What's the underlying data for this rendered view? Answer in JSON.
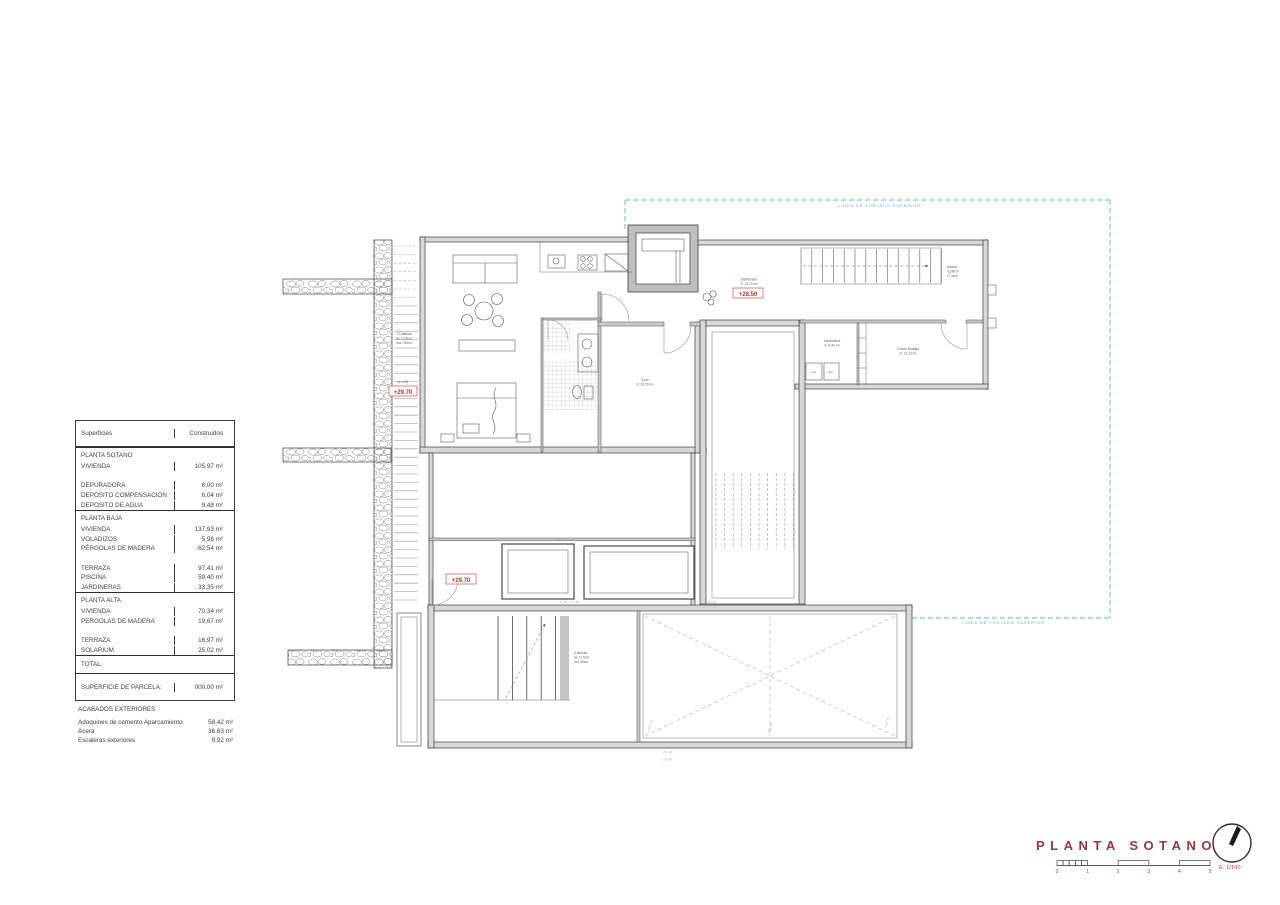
{
  "table": {
    "col1_header": "Superficies",
    "col2_header": "Construidos",
    "sections": [
      {
        "title": "PLANTA SOTANO",
        "rows": [
          [
            "VIVIENDA",
            "105,97 m²"
          ],
          [
            "",
            ""
          ],
          [
            "DEPURADORA",
            "6,00 m²"
          ],
          [
            "DEPOSITO COMPENSACIÓN",
            "6,04 m²"
          ],
          [
            "DEPOSITO DE AGUA",
            "9,48 m²"
          ]
        ]
      },
      {
        "title": "PLANTA BAJA",
        "rows": [
          [
            "VIVIENDA",
            "137,93 m²"
          ],
          [
            "VOLADIZOS",
            "5,98 m²"
          ],
          [
            "PÉRGOLAS DE MADERA",
            "62,54 m²"
          ],
          [
            "",
            ""
          ],
          [
            "TERRAZA",
            "97,41 m²"
          ],
          [
            "PISCINA",
            "59,40 m²"
          ],
          [
            "JARDINERAS",
            "33,35 m²"
          ]
        ]
      },
      {
        "title": "PLANTA ALTA",
        "rows": [
          [
            "VIVIENDA",
            "70,34 m²"
          ],
          [
            "PERGOLAS DE MADERA",
            "19,67 m²"
          ],
          [
            "",
            ""
          ],
          [
            "TERRAZA",
            "16,97 m²"
          ],
          [
            "SOLARIUM",
            "25,02 m²"
          ]
        ]
      }
    ],
    "total_label": "TOTAL.",
    "parcela_label": "SUPERFICIE DE PARCELA:",
    "parcela_value": "000,00 m²"
  },
  "acabados": {
    "title": "ACABADOS EXTERIORES",
    "rows": [
      [
        "Adoquines de cemento Aparcamiento",
        "58,42 m²"
      ],
      [
        "Acera",
        "36,63 m²"
      ],
      [
        "Escaleras exteriores",
        "9,92 m²"
      ]
    ]
  },
  "titleblock": {
    "title": "PLANTA SOTANO",
    "scale_numbers": [
      "0",
      "1",
      "2",
      "3",
      "4",
      "5"
    ],
    "scale_label": "E. 1/100"
  },
  "plan": {
    "forjado_top": "LINEA DE FORJADO SUPERIOR",
    "forjado_bottom": "LINEA DE FORJADO SUPERIOR",
    "level_hall": "+28.50",
    "level_stair": "+29.70",
    "level_tanks": "+29.70",
    "hall_room": {
      "name": "Distribuidor",
      "area": "S: 13,70 m²"
    },
    "gym_room": {
      "name": "Gym",
      "area": "S: 32,70 m²"
    },
    "laundry_room": {
      "name": "Lavandería",
      "area": "S: 6,44 m²"
    },
    "bodega_room": {
      "name": "Cuarto Bodega",
      "area": "S: 13,13 m²"
    },
    "machine_1": "Lav.",
    "machine_2": "Sec.",
    "stair_note_left": [
      "17 tabicas",
      "de 17,5cm",
      "hue. 30cm"
    ],
    "stair_note_left_dim": "A: 4,05",
    "stair_note_upper": [
      "subida:",
      "4,285 m",
      "17 peld."
    ],
    "stair_note_garage": [
      "6 tabicas",
      "de 17,5cm",
      "con 30cm"
    ],
    "garage_spot_level": "+29,70",
    "dims": {
      "tanks_top": "5,60 x 4,90",
      "tanks_bottom": "5,60 x 4,90",
      "garage_top": "15,40",
      "garage_bottom_1": "28,10",
      "garage_bottom_2": "29,45"
    }
  }
}
